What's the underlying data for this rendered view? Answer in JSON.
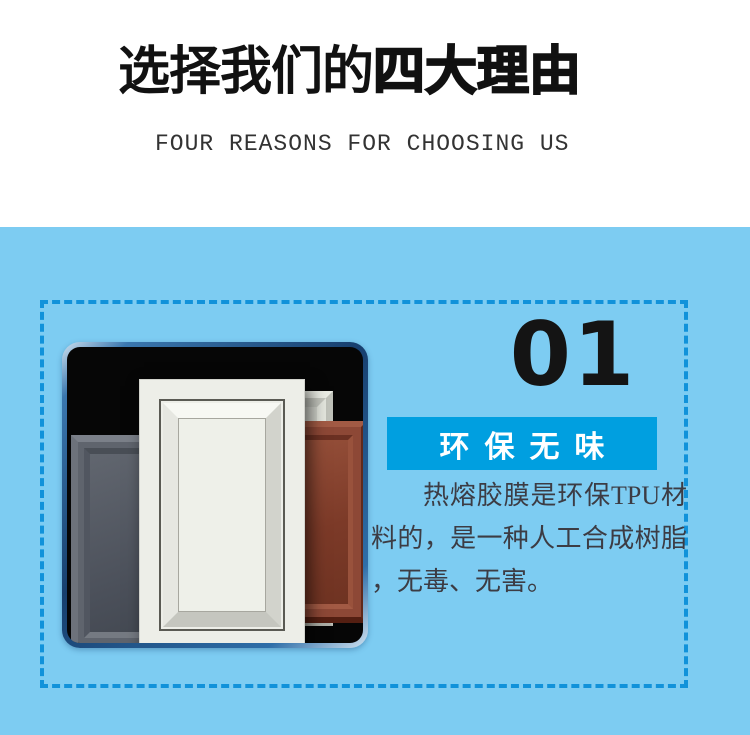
{
  "colors": {
    "section-bg": "#7dccf2",
    "dash-border": "#1192da",
    "banner-bg": "#009fe0",
    "banner-text": "#ffffff",
    "title-text": "#111111",
    "subtitle-text": "#333333",
    "number-text": "#141414",
    "paragraph-text": "#3c3c44"
  },
  "header": {
    "title_regular": "选择我们的",
    "title_bold": "四大理由",
    "subtitle": "FOUR REASONS FOR CHOOSING US"
  },
  "reason": {
    "number": "01",
    "title": "环保无味",
    "description": "热熔胶膜是环保TPU材料的，是一种人工合成树脂，无毒、无害。"
  },
  "image": {
    "semantic": "cabinet-door-color-samples"
  }
}
